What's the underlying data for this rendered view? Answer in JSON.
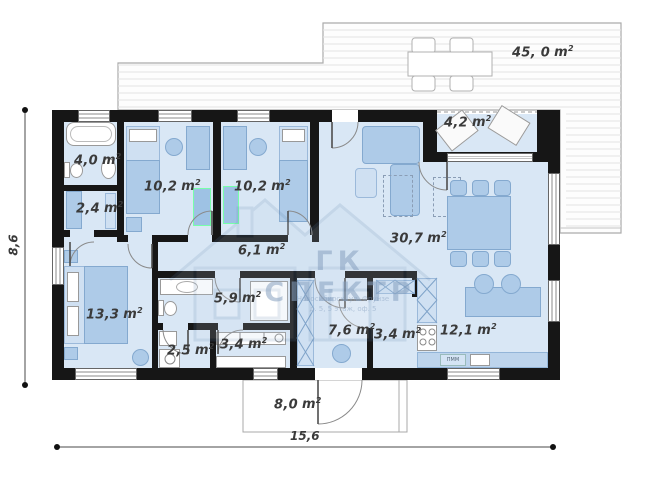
{
  "plan": {
    "unit": "m",
    "unit_sup": "2",
    "dimensions": {
      "length": "15,6",
      "height": "8,6"
    },
    "watermark": {
      "title": "ГК СПЕКТР",
      "address_line1": "Новосибирск, ул. Фрунзе",
      "address_line2": "д. 5, 5 этаж, оф. 5"
    },
    "kitchen_appliance_label": "ПММ",
    "rooms": [
      {
        "name": "bathroom",
        "area": "4,0"
      },
      {
        "name": "wardrobe",
        "area": "2,4"
      },
      {
        "name": "bedroom-1",
        "area": "10,2"
      },
      {
        "name": "bedroom-2",
        "area": "10,2"
      },
      {
        "name": "hallway",
        "area": "6,1"
      },
      {
        "name": "bedroom-3",
        "area": "13,3"
      },
      {
        "name": "bathroom-2",
        "area": "5,9"
      },
      {
        "name": "wc",
        "area": "2,5"
      },
      {
        "name": "storage",
        "area": "3,4"
      },
      {
        "name": "entry-hall",
        "area": "7,6"
      },
      {
        "name": "wardrobe-2",
        "area": "3,4"
      },
      {
        "name": "living-room",
        "area": "30,7"
      },
      {
        "name": "kitchen",
        "area": "12,1"
      },
      {
        "name": "entry-terrace",
        "area": "4,2"
      },
      {
        "name": "terrace",
        "area": "45, 0"
      },
      {
        "name": "porch",
        "area": "8,0"
      }
    ]
  }
}
